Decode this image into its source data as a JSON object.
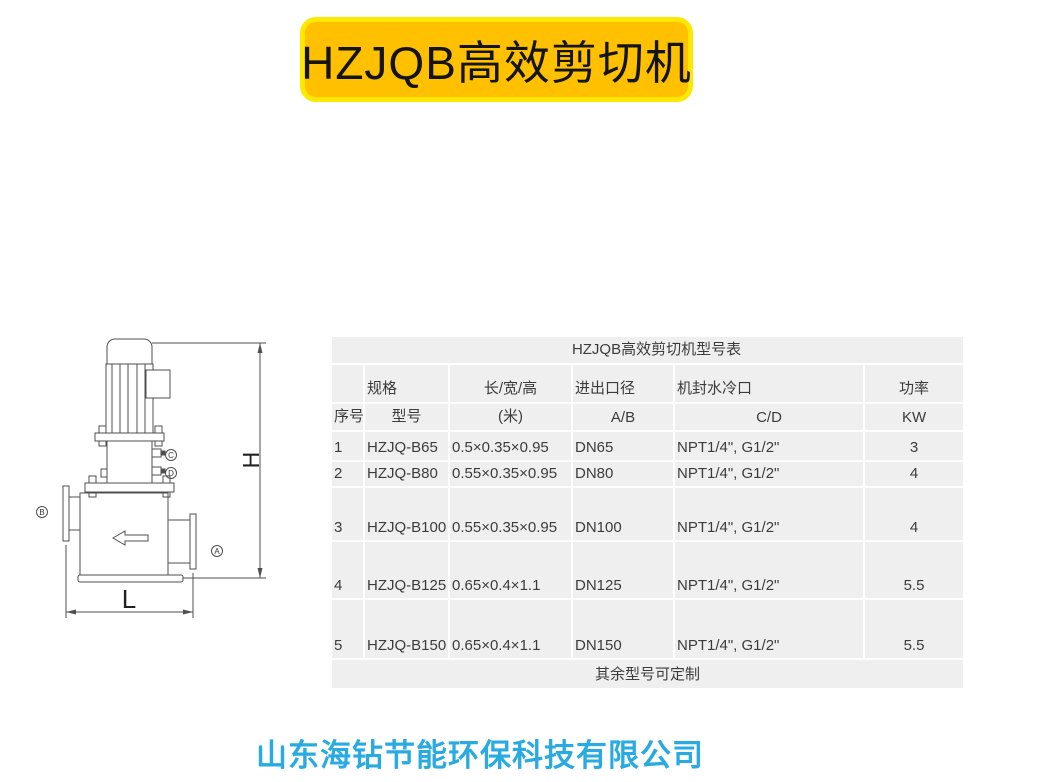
{
  "banner": {
    "title": "HZJQB高效剪切机",
    "fill_color": "#FFC000",
    "border_color": "#FFE800"
  },
  "drawing": {
    "dim_height_label": "H",
    "dim_length_label": "L",
    "port_a_label": "A",
    "port_b_label": "B",
    "port_c_label": "C",
    "port_d_label": "D"
  },
  "table": {
    "title": "HZJQB高效剪切机型号表",
    "header_row1": {
      "c0": "",
      "c1": "规格",
      "c2": "长/宽/高",
      "c3": "进出口径",
      "c4": "机封水冷口",
      "c5": "功率"
    },
    "header_row2": {
      "c0": "序号",
      "c1": "型号",
      "c2": "(米)",
      "c3": "A/B",
      "c4": "C/D",
      "c5": "KW"
    },
    "rows": [
      {
        "no": "1",
        "model": "HZJQ-B65",
        "size": "0.5×0.35×0.95",
        "port": "DN65",
        "seal": "NPT1/4\", G1/2\"",
        "power": "3"
      },
      {
        "no": "2",
        "model": "HZJQ-B80",
        "size": "0.55×0.35×0.95",
        "port": "DN80",
        "seal": "NPT1/4\", G1/2\"",
        "power": "4"
      },
      {
        "no": "3",
        "model": "HZJQ-B100",
        "size": "0.55×0.35×0.95",
        "port": "DN100",
        "seal": "NPT1/4\", G1/2\"",
        "power": "4"
      },
      {
        "no": "4",
        "model": "HZJQ-B125",
        "size": "0.65×0.4×1.1",
        "port": "DN125",
        "seal": "NPT1/4\", G1/2\"",
        "power": "5.5"
      },
      {
        "no": "5",
        "model": "HZJQ-B150",
        "size": "0.65×0.4×1.1",
        "port": "DN150",
        "seal": "NPT1/4\", G1/2\"",
        "power": "5.5"
      }
    ],
    "footer_note": "其余型号可定制",
    "background_color": "#EFEFEF",
    "gridline_color": "#FFFFFF"
  },
  "footer": {
    "company_name": "山东海钻节能环保科技有限公司",
    "color": "#29ABE2"
  }
}
